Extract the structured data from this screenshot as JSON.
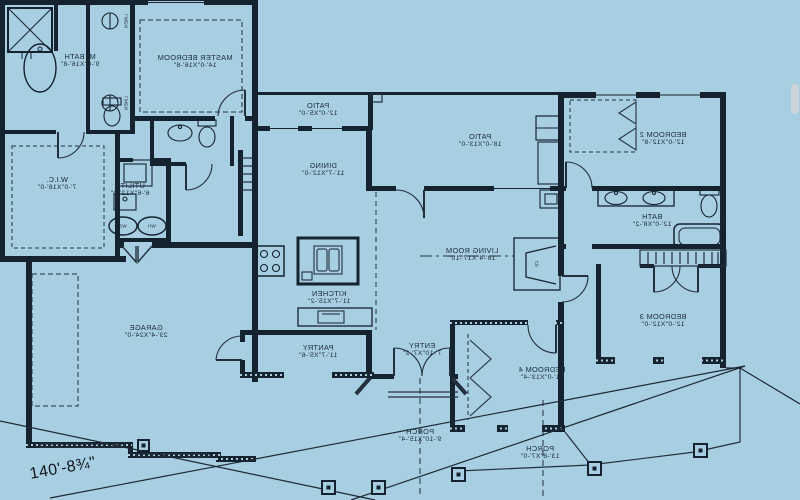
{
  "canvas": {
    "background": "#a7cee1",
    "ink": "#152330",
    "thin_line": "#22303d",
    "label_color": "#1d2c3a",
    "scrollbar_color": "#ccd4d9",
    "note": "floor plan rendered mirrored (reversed) as shown"
  },
  "dimension_label": "140'-8¾\"",
  "rooms": [
    {
      "name": "M. BATH",
      "dims": "9'-0\"X16'-8\""
    },
    {
      "name": "MASTER BEDROOM",
      "dims": "14'-0\"X16'-8\""
    },
    {
      "name": "W.I.C.",
      "dims": "7'-0\"X16'-0\""
    },
    {
      "name": "UTILITY",
      "dims": "6'-6\"X12'-0\""
    },
    {
      "name": "DINING",
      "dims": "11'-7\"X12'-0\""
    },
    {
      "name": "PATIO",
      "dims": "12'-0\"X5'-0\""
    },
    {
      "name": "PATIO",
      "dims": "18'-0\"X13'-0\""
    },
    {
      "name": "LIVING ROOM",
      "dims": "18'-4\"X17'-10\""
    },
    {
      "name": "KITCHEN",
      "dims": "11'-7\"X15'-2\""
    },
    {
      "name": "PANTRY",
      "dims": "11'-7\"X5'-6\""
    },
    {
      "name": "ENTRY",
      "dims": "7'-10\"X7'-2\""
    },
    {
      "name": "BEDROOM 4",
      "dims": "11'-0\"X13'-4\""
    },
    {
      "name": "BEDROOM 2",
      "dims": "12'-0\"X12'-8\""
    },
    {
      "name": "BATH",
      "dims": "12'-0\"X8'-2\""
    },
    {
      "name": "BEDROOM 3",
      "dims": "12'-0\"X12'-0\""
    },
    {
      "name": "PORCH",
      "dims": "9'-10\"X15'-4\""
    },
    {
      "name": "PORCH",
      "dims": "13'-8\"X7'-0\""
    },
    {
      "name": "GARAGE",
      "dims": "23'-4\"X24'-0\""
    }
  ],
  "fixtures": {
    "linen_label": "LINEN",
    "water_softener_label": "WS",
    "water_heater_label": "WH",
    "fireplace_label": "FP"
  }
}
